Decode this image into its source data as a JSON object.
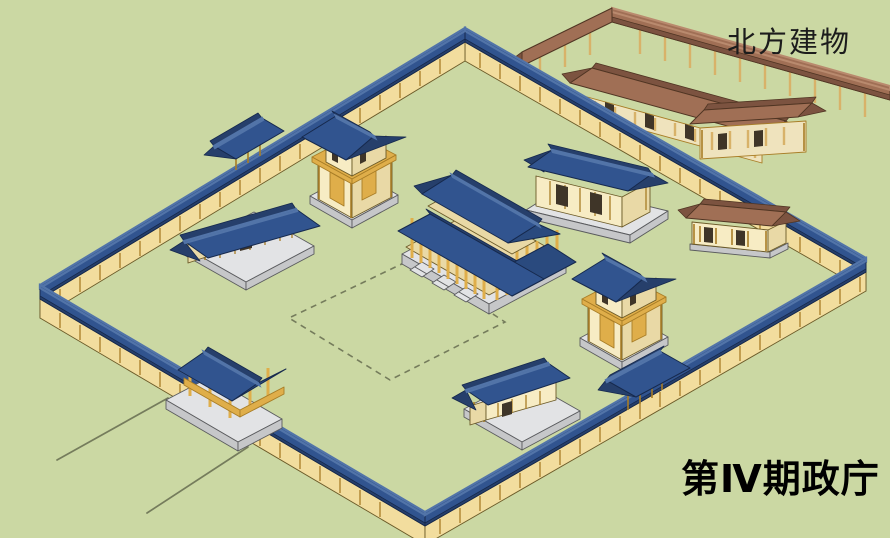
{
  "diagram": {
    "north_label": "北方建物",
    "title_label": "第Ⅳ期政庁",
    "scene": "isometric reconstruction of phase-IV government office compound",
    "elements": [
      "compound-wall",
      "south-gate",
      "northwest-gate",
      "southeast-gate",
      "main-hall",
      "west-hall",
      "northeast-hall",
      "south-hall",
      "northwest-tower",
      "southeast-tower",
      "east-outbuilding",
      "northern-buildings",
      "courtyard-dashed-outline",
      "approach-road"
    ]
  },
  "colors": {
    "bg": "#cbd8a3",
    "roof-blue": "#31548f",
    "roof-blue-mid": "#2a4a7e",
    "roof-blue-dark": "#263f6b",
    "roof-blue-deep": "#16294d",
    "roof-blue-light": "#5274a8",
    "wall-tan": "#f2dd9e",
    "wall-outline": "#6b5a28",
    "wood": "#dfae4a",
    "wood-dark": "#a87d26",
    "cream": "#f7ecc4",
    "cream-shade": "#e9d9a6",
    "base-gray": "#e2e3e5",
    "base-gray-side": "#c6c7c9",
    "gray-outline": "#5a5b5e",
    "brown": "#a06f55",
    "brown-dark": "#7c5340",
    "brown-deep": "#503523",
    "brown-light": "#b98a6e",
    "north-wall": "#efe3bd",
    "north-post": "#d8b269",
    "opening": "#3f3528",
    "line-olive": "#757c5c",
    "ink": "#1c1c1c"
  }
}
